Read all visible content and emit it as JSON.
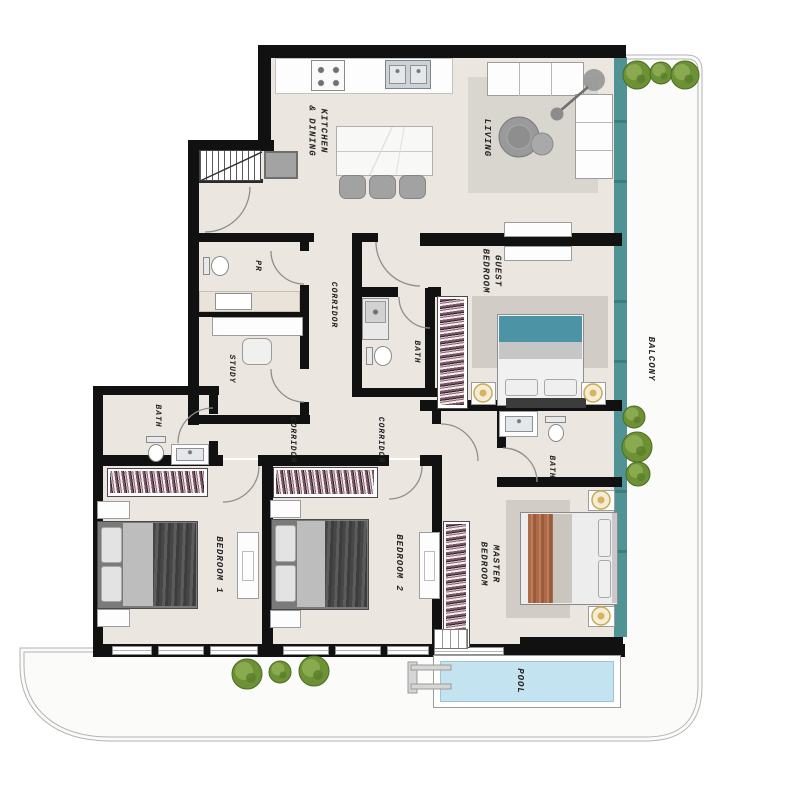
{
  "rooms": {
    "kitchen_dining": "KITCHEN\n& DINING",
    "living": "LIVING",
    "guest_bedroom": "GUEST\nBEDROOM",
    "powder_room": "PR",
    "corridor_upper": "CORRIDOR",
    "study": "STUDY",
    "bath_middle": "BATH",
    "bath_bedroom1": "BATH",
    "corridor_bedroom1": "CORRIDOR",
    "corridor_bedroom2": "CORRIDOR",
    "bath_master": "BATH",
    "bedroom_1": "BEDROOM 1",
    "bedroom_2": "BEDROOM 2",
    "master_bedroom": "MASTER\nBEDROOM",
    "balcony": "BALCONY",
    "pool": "POOL"
  },
  "colors": {
    "wall": "#111111",
    "floor": "#ebe7e0",
    "rug": "#d9d5cf",
    "glass": "#4f9394",
    "pool_water": "#c4e3f0",
    "plant": "#6d9135",
    "guest_bed_accent": "#4b93a5",
    "master_throw": "#ad6a48",
    "balcony_floor": "#fbfbf9"
  }
}
